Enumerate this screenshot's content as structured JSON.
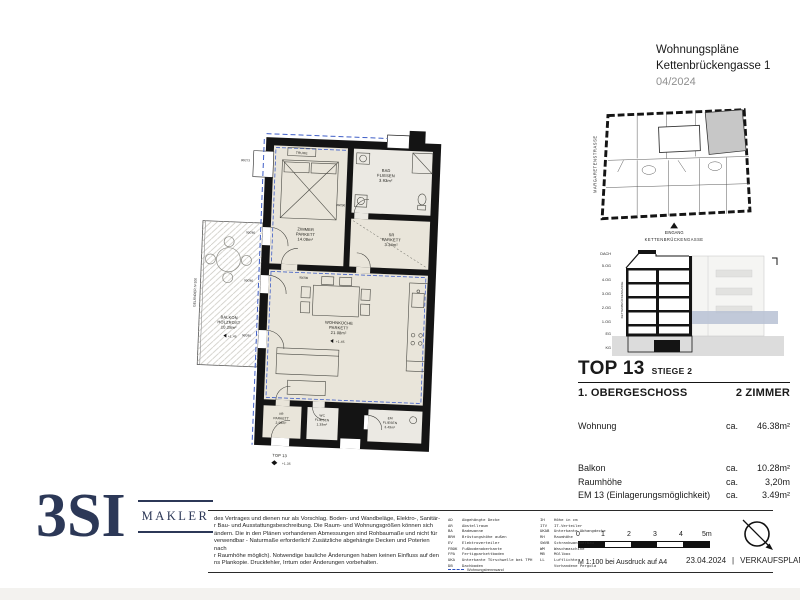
{
  "header": {
    "title": "Wohnungspläne",
    "address": "Kettenbrückengasse 1",
    "date": "04/2024"
  },
  "siteplan": {
    "street_left": "MARGARETENSTRASSE",
    "entrance": "EINGANG",
    "street_bottom": "KETTENBRÜCKENGASSE"
  },
  "section": {
    "floors": [
      "DACH",
      "5.OG",
      "4.OG",
      "3.OG",
      "2.OG",
      "1.OG",
      "EG",
      "KG"
    ],
    "street": "KETTENBRÜCKENGASSE"
  },
  "info": {
    "top": "TOP 13",
    "stiege": "STIEGE 2",
    "floor": "1. OBERGESCHOSS",
    "rooms": "2 ZIMMER",
    "wohnung_label": "Wohnung",
    "ca": "ca.",
    "wohnung_area": "46.38m²"
  },
  "details": {
    "rows": [
      {
        "label": "Balkon",
        "ca": "ca.",
        "value": "10.28m²"
      },
      {
        "label": "Raumhöhe",
        "ca": "ca.",
        "value": "3,20m"
      },
      {
        "label": "EM 13 (Einlagerungsmöglichkeit)",
        "ca": "ca.",
        "value": "3.49m²"
      }
    ]
  },
  "scalebar": {
    "ticks": [
      "0",
      "1",
      "2",
      "3",
      "4",
      "5m"
    ],
    "caption": "M 1:100 bei Ausdruck auf A4",
    "date": "23.04.2024",
    "separator": "|",
    "doc": "VERKAUFSPLAN"
  },
  "logo": {
    "name": "3SI",
    "sub": "MAKLER"
  },
  "footer": {
    "disclaimer": "des Vertrages und dienen nur als Vorschlag. Boden- und Wandbeläge, Elektro-, Sanitär-\nr Bau- und Ausstattungsbeschreibung. Die Raum- und Wohnungsgrößen können sich\nändern. Die in den Plänen vorhandenen Abmessungen sind Rohbaumaße und nicht für\nverwendbar - Naturmaße erforderlich! Zusätzliche abgehängte Decken und Poterien nach\nr Raumhöhe möglich). Notwendige bauliche Änderungen haben keinen Einfluss auf den\nns Plankopie. Druckfehler, Irrtum oder Änderungen vorbehalten.",
    "legend_col1": "AD    Abgehängte Decke\nAR    Abstellraum\nBA    Badewanne\nBRH   Brüstungshöhe außen\nEV    Elektroverteiler\nFBOK  Fußbodenoberkante\nFPA   Fertigparkettboden\nUKA   Unterkante Türschwelle bei TPH\nDB    Dachboden",
    "legend_col2": "IH    Höhe in cm\nITV   IT-Verteiler\nUKAB  Unterkante Abhangdecke\nRH    Raumhöhe\nSWVB  Schrankwandverbau\nWM    Waschmaschine\nMB    Müllbox\nLL    Luftlichte\n      Vorhandene Pergola",
    "legend_note": "Wohnungstrennwand"
  },
  "floorplan": {
    "rooms": [
      {
        "name": "ZIMMER",
        "floor": "PARKETT",
        "area": "14.08m²"
      },
      {
        "name": "BAD",
        "floor": "FLIESEN",
        "area": "3.93m²"
      },
      {
        "name": "SR",
        "floor": "PARKETT",
        "area": "3.34m²"
      },
      {
        "name": "WOHNKÜCHE",
        "floor": "PARKETT",
        "area": "21.08m²"
      },
      {
        "name": "VR",
        "floor": "PARKETT",
        "area": "2.56m²"
      },
      {
        "name": "WC",
        "floor": "FLIESEN",
        "area": "1.39m²"
      },
      {
        "name": "EM",
        "floor": "FLIESEN",
        "area": "3.49m²"
      },
      {
        "name": "BALKON",
        "floor": "HOLZROST",
        "area": "10.28m²"
      }
    ],
    "labels": {
      "truhe": "TRUHE",
      "gelaender": "GELÄNDER h=100",
      "balkon_level": "+1.45",
      "wk_level": "+1.45",
      "top": "TOP 13",
      "top_level": "+1.35"
    },
    "dims": [
      "80/273",
      "90/260",
      "90/260",
      "90/260",
      "80/200",
      "90/200"
    ]
  }
}
